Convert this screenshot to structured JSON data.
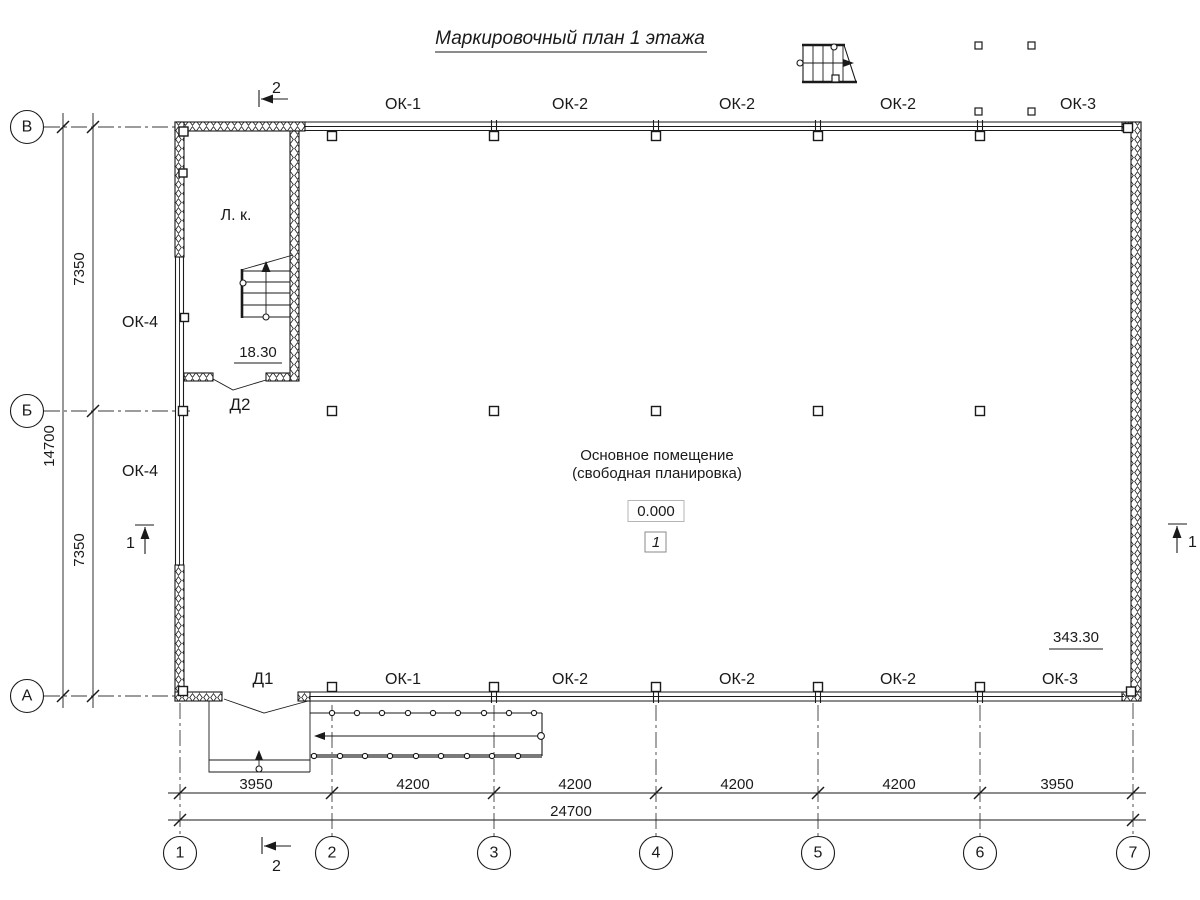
{
  "title": "Маркировочный план 1 этажа",
  "room": {
    "name_line1": "Основное помещение",
    "name_line2": "(свободная планировка)",
    "elevation": "0.000",
    "number": "1"
  },
  "stair": {
    "room_label": "Л. к.",
    "elevation": "18.30"
  },
  "doors": {
    "d1": "Д1",
    "d2": "Д2"
  },
  "area_mark": "343.30",
  "windows": {
    "top": [
      "ОК-1",
      "ОК-2",
      "ОК-2",
      "ОК-2",
      "ОК-3"
    ],
    "bottom": [
      "ОК-1",
      "ОК-2",
      "ОК-2",
      "ОК-2",
      "ОК-3"
    ],
    "left": [
      "ОК-4",
      "ОК-4"
    ]
  },
  "axes": {
    "horizontal": [
      "В",
      "Б",
      "А"
    ],
    "vertical": [
      "1",
      "2",
      "3",
      "4",
      "5",
      "6",
      "7"
    ]
  },
  "dimensions": {
    "bottom_segments": [
      "3950",
      "4200",
      "4200",
      "4200",
      "4200",
      "3950"
    ],
    "bottom_total": "24700",
    "left_segments": [
      "7350",
      "7350"
    ],
    "left_total": "14700"
  },
  "sections": {
    "mark1": "1",
    "mark2": "2"
  },
  "colors": {
    "line": "#1a1a1a",
    "grid": "#3a3a3a",
    "ramp_edge": "#7a7a7a",
    "background": "#ffffff"
  }
}
